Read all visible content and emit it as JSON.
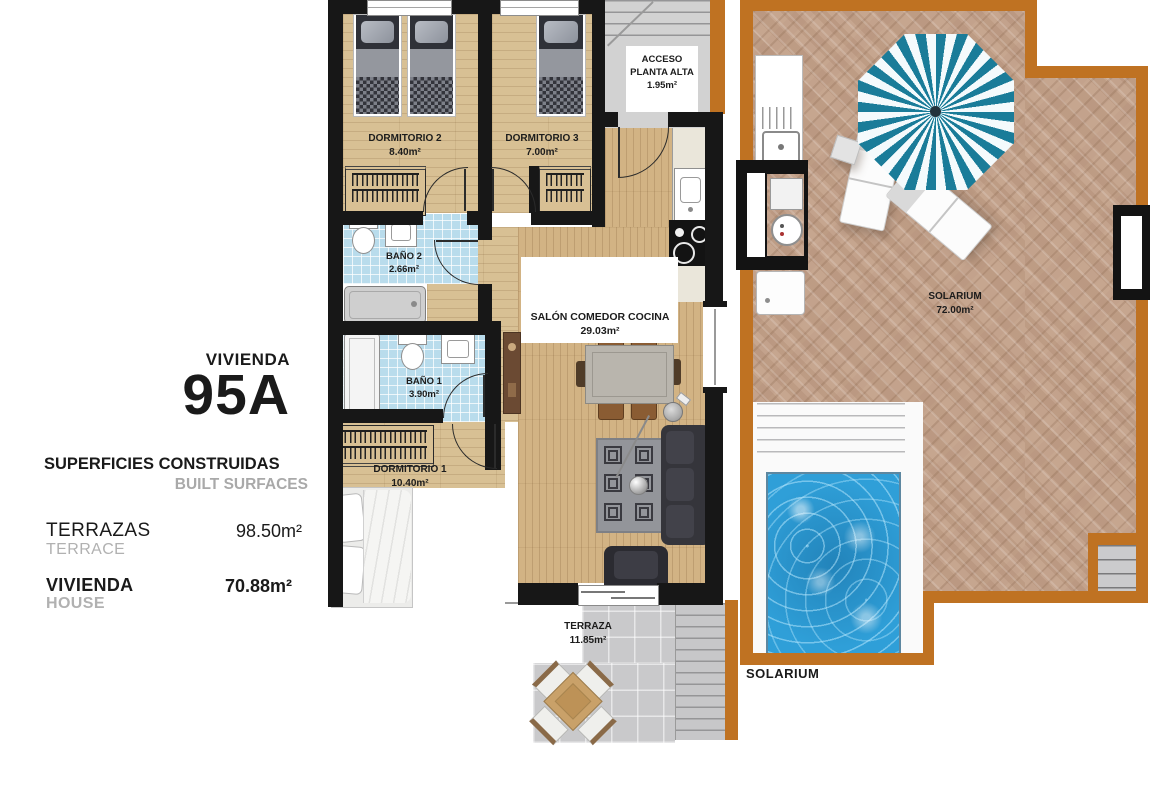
{
  "panel": {
    "unit_label": "VIVIENDA",
    "unit_number": "95A",
    "surfaces_title": "SUPERFICIES CONSTRUIDAS",
    "surfaces_title_en": "BUILT SURFACES",
    "terrazas_label": "TERRAZAS",
    "terrazas_label_en": "TERRACE",
    "terrazas_value": "98.50m²",
    "vivienda_label": "VIVIENDA",
    "vivienda_label_en": "HOUSE",
    "vivienda_value": "70.88m²"
  },
  "rooms": {
    "dormitorio2": {
      "name": "DORMITORIO 2",
      "area": "8.40m²"
    },
    "dormitorio3": {
      "name": "DORMITORIO 3",
      "area": "7.00m²"
    },
    "bano2": {
      "name": "BAÑO 2",
      "area": "2.66m²"
    },
    "bano1": {
      "name": "BAÑO 1",
      "area": "3.90m²"
    },
    "dormitorio1": {
      "name": "DORMITORIO 1",
      "area": "10.40m²"
    },
    "salon": {
      "name": "SALÓN COMEDOR COCINA",
      "area": "29.03m²"
    },
    "acceso": {
      "line1": "ACCESO",
      "line2": "PLANTA ALTA",
      "area": "1.95m²"
    },
    "terraza": {
      "name": "TERRAZA",
      "area": "11.85m²"
    },
    "solarium": {
      "name": "SOLARIUM",
      "area": "72.00m²"
    }
  },
  "exterior": {
    "solarium_caption": "SOLARIUM"
  },
  "colors": {
    "wall": "#171717",
    "exterior_wall": "#bf7222",
    "bathroom_tile": "#b9dcec",
    "pool_water": "#2f9fd8",
    "umbrella_teal": "#1a7c99",
    "brick": "#c3a28c",
    "wood": "#d8c094",
    "terrace_tile": "#c9c9cb"
  }
}
